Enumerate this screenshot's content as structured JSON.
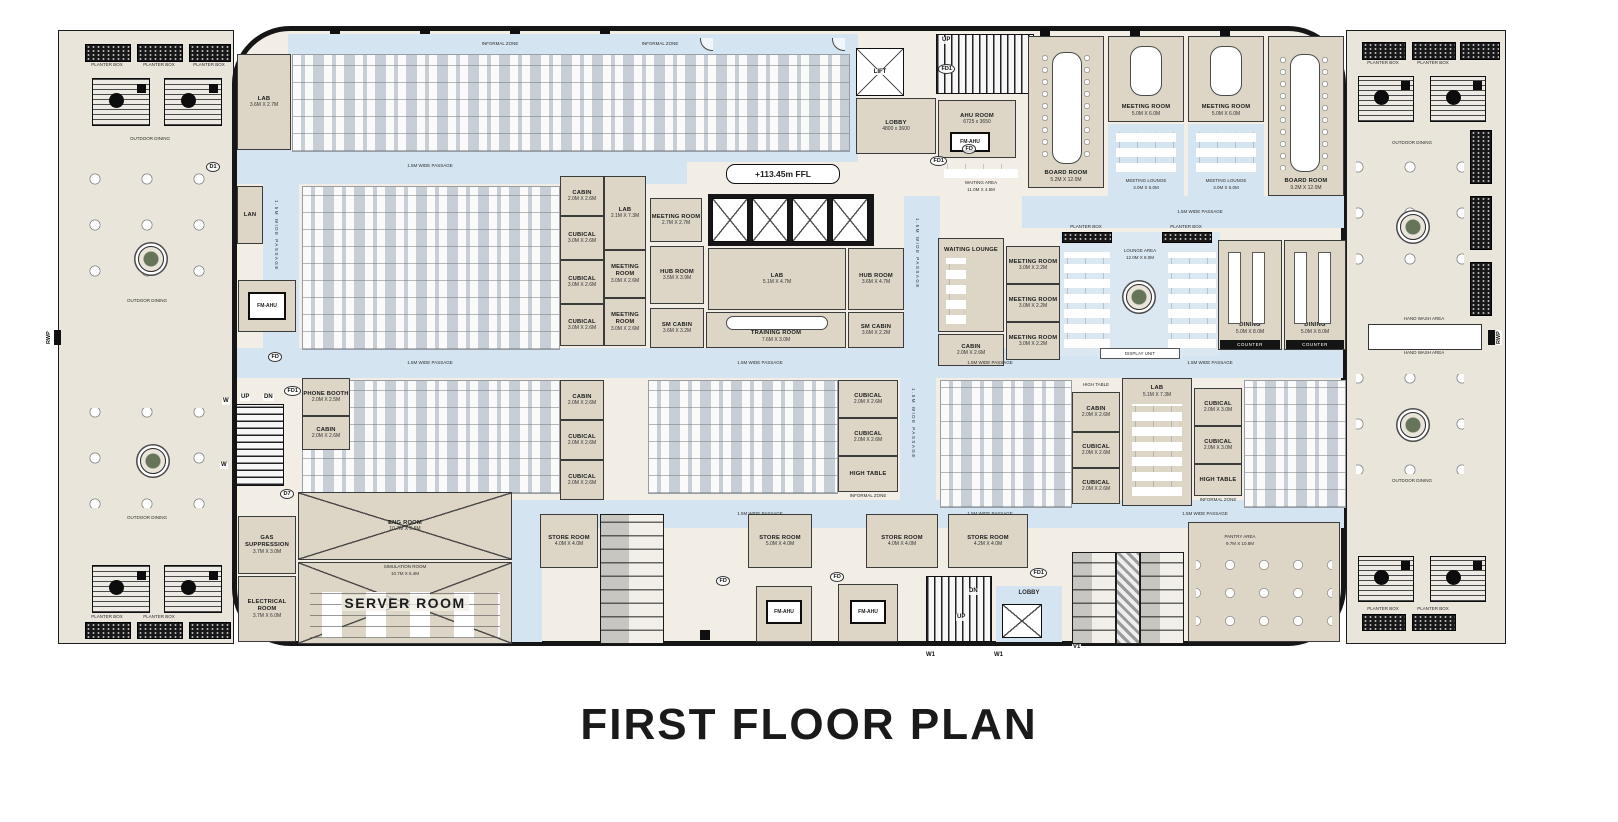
{
  "title": "FIRST FLOOR PLAN",
  "colors": {
    "wall": "#161616",
    "outdoor": "#e9e5da",
    "interior": "#f2eee5",
    "passage": "#d4e4f0",
    "carpet": "#c7ced5",
    "room_fill": "#ddd6c7"
  },
  "labels": {
    "planter_box": "PLANTER BOX",
    "outdoor_dining": "OUTDOOR DINING",
    "informal_zone": "INFORMAL ZONE",
    "passage": "1.5M WIDE PASSAGE",
    "counter": "COUNTER",
    "high_table": "HIGH TABLE",
    "display_unit": "DISPLAY UNIT",
    "hand_wash_area": "HAND WASH AREA",
    "ffl": "+113.45m FFL",
    "waiting_area": "WAITING AREA",
    "waiting_area_dims": "11.0M X 4.5M",
    "lounge_area": "LOUNGE AREA",
    "lounge_area_dims": "12.0M X 8.0M",
    "waiting_lounge": "WAITING LOUNGE"
  },
  "markers": {
    "up": "UP",
    "dn": "DN",
    "lift": "LIFT",
    "lobby": "LOBBY",
    "fd": "FD",
    "fd1": "FD1",
    "d1": "D1",
    "d7": "D7",
    "w": "W",
    "w1": "W1",
    "v1": "V1",
    "rwp": "RWP"
  },
  "rooms": {
    "lobby_top": {
      "name": "LOBBY",
      "dims": "4800 x 3600"
    },
    "ahu_room": {
      "name": "AHU ROOM",
      "dims": "6725 x 3650"
    },
    "fm_ahu": {
      "name": "FM-AHU"
    },
    "lan": {
      "name": "LAN"
    },
    "lab_a": {
      "name": "LAB",
      "dims": "3.6M X 2.7M"
    },
    "lab_b": {
      "name": "LAB",
      "dims": "2.1M X 7.3M"
    },
    "lab_c": {
      "name": "LAB",
      "dims": "5.1M X 4.7M"
    },
    "lab_d": {
      "name": "LAB",
      "dims": "5.1M X 7.3M"
    },
    "cabin": {
      "name": "CABIN",
      "dims": "2.0M X 2.6M"
    },
    "cubical_s": {
      "name": "CUBICAL",
      "dims": "2.0M X 2.6M"
    },
    "cubical_m": {
      "name": "CUBICAL",
      "dims": "3.0M X 2.6M"
    },
    "cubical_l": {
      "name": "CUBICAL",
      "dims": "2.0M X 3.0M"
    },
    "meeting_s": {
      "name": "MEETING ROOM",
      "dims": "3.0M X 2.6M"
    },
    "meeting_27": {
      "name": "MEETING ROOM",
      "dims": "2.7M X 2.7M"
    },
    "meeting_22": {
      "name": "MEETING ROOM",
      "dims": "3.0M X 2.2M"
    },
    "hub_a": {
      "name": "HUB ROOM",
      "dims": "3.5M X 3.9M"
    },
    "hub_b": {
      "name": "HUB ROOM",
      "dims": "3.6M X 4.7M"
    },
    "sm_cabin_a": {
      "name": "SM CABIN",
      "dims": "3.6M X 3.2M"
    },
    "sm_cabin_b": {
      "name": "SM CABIN",
      "dims": "3.6M X 2.2M"
    },
    "training": {
      "name": "TRAINING ROOM",
      "dims": "7.6M X 3.0M"
    },
    "phone_booth": {
      "name": "PHONE BOOTH",
      "dims": "2.0M X 2.5M"
    },
    "meeting_room": {
      "name": "MEETING ROOM",
      "dims": "5.0M X 6.0M"
    },
    "board_room_l": {
      "name": "BOARD ROOM",
      "dims": "5.2M X 12.0M"
    },
    "board_room_r": {
      "name": "BOARD ROOM",
      "dims": "9.2M X 12.0M"
    },
    "meeting_lounge": {
      "name": "MEETING LOUNGE",
      "dims": "3.0M X 5.0M"
    },
    "dining": {
      "name": "DINING",
      "dims": "5.0M X 8.0M"
    },
    "store_a": {
      "name": "STORE ROOM",
      "dims": "4.0M X 4.0M"
    },
    "store_b": {
      "name": "STORE ROOM",
      "dims": "5.0M X 4.0M"
    },
    "store_c": {
      "name": "STORE ROOM",
      "dims": "4.2M X 4.0M"
    },
    "pantry": {
      "name": "PANTRY AREA",
      "dims": "9.7M X 10.8M"
    },
    "server": {
      "name": "SERVER ROOM"
    },
    "eng": {
      "name": "ENG ROOM",
      "dims": "10.7M X 6.5M"
    },
    "simulation": {
      "name": "SIMULATION ROOM",
      "dims": "10.7M X 6.4M"
    },
    "electrical": {
      "name": "ELECTRICAL ROOM",
      "dims": "3.7M X 6.0M"
    },
    "gas": {
      "name": "GAS SUPPRESSION",
      "dims": "3.7M X 3.0M"
    }
  }
}
